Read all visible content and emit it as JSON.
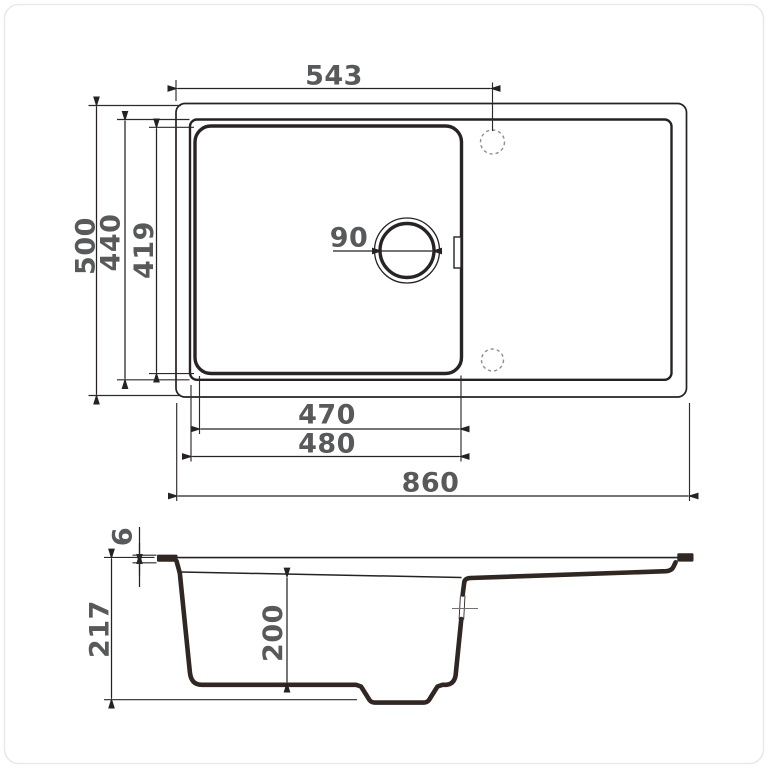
{
  "drawing": {
    "type": "technical-dimension-drawing",
    "subject": "kitchen sink with drainboard, top view and side section view",
    "units": "mm",
    "colors": {
      "outline": "#262223",
      "profile": "#302622",
      "dimension_text": "#58595b",
      "dashed_hole": "#8f8f8f",
      "background": "#ffffff",
      "border": "#e9e9e9"
    },
    "top_view": {
      "dimensions": {
        "faucet_offset": "543",
        "overall_depth": "500",
        "rim_depth": "440",
        "bowl_depth_plan": "419",
        "drain_diameter": "90",
        "bowl_width_inner": "470",
        "bowl_width_outer": "480",
        "overall_width": "860"
      }
    },
    "side_view": {
      "dimensions": {
        "rim_thickness": "6",
        "overall_height": "217",
        "bowl_height": "200"
      }
    }
  }
}
